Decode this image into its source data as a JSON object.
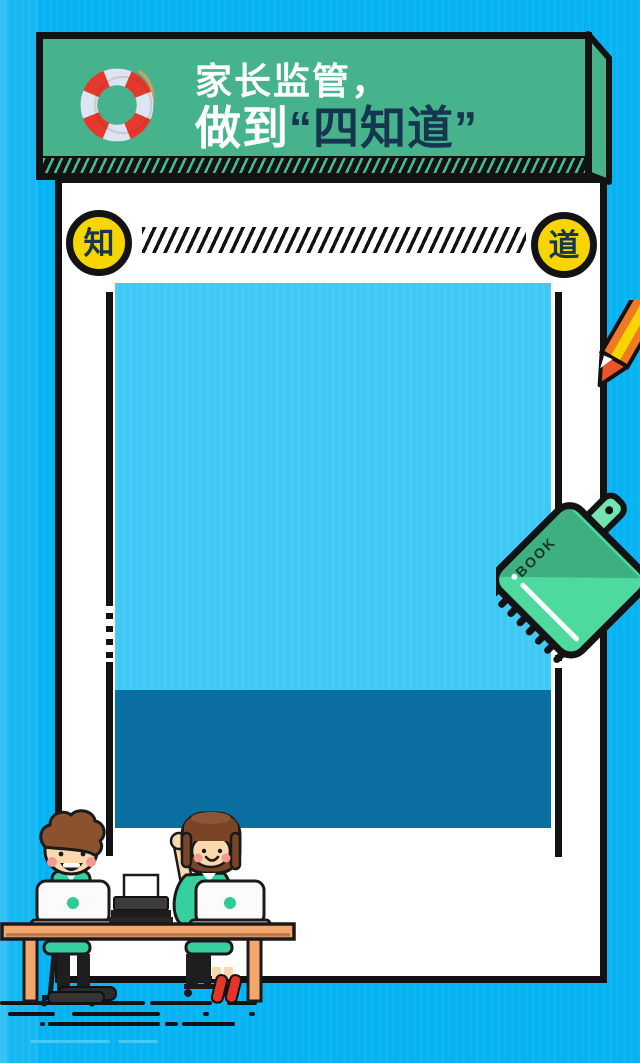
{
  "poster": {
    "background_color": "#05B3F2",
    "banner": {
      "icon": "lifebuoy-icon",
      "title_line1": "家长监管，",
      "title_line2_prefix": "做到",
      "title_line2_quoted": "“四知道”",
      "bg_color": "#46B38C",
      "accent_text_color": "#16354E"
    },
    "knowledge_divider": {
      "left_badge": "知",
      "right_badge": "道",
      "badge_bg_color": "#F7D600",
      "badge_text_color": "#17364F"
    },
    "image_area": {
      "main_color": "#3EC8F6",
      "caption_bar_color": "#0A6FA0"
    },
    "decorations": {
      "notebook_label": "BOOK",
      "notebook_color": "#4ED99F",
      "pencil_color": "#F07A22",
      "desk_color": "#F3A76C",
      "shirt_color": "#38CFA0"
    }
  }
}
